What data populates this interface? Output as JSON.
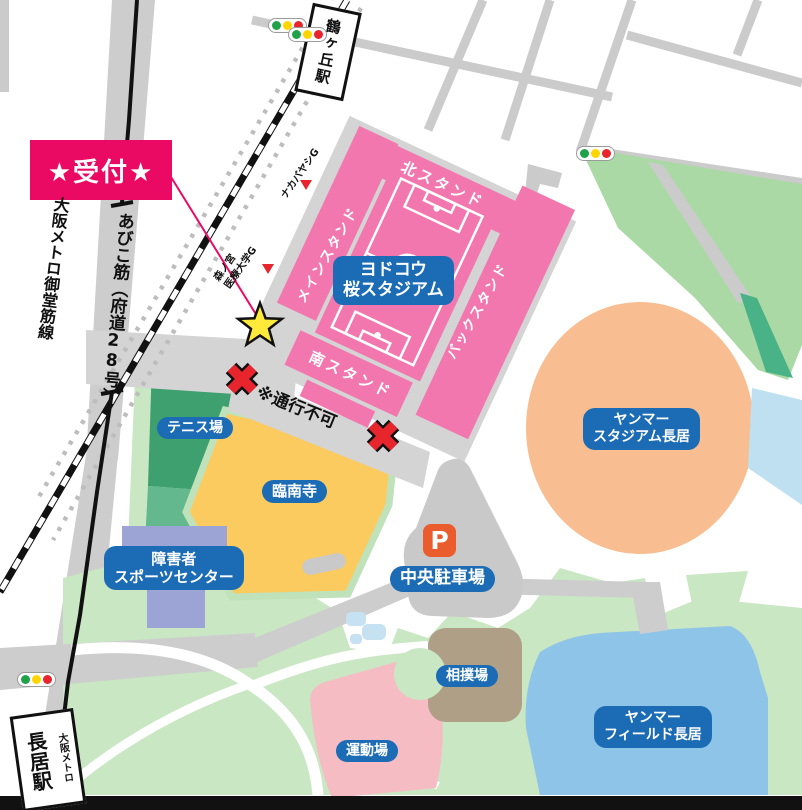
{
  "reception": {
    "label": "★受付★"
  },
  "stations": {
    "tsurugaoka": "鶴ヶ丘駅",
    "nagai": "長居駅",
    "nagai_operator": "大阪メトロ"
  },
  "roads": {
    "metro_line": "大阪メトロ御堂筋線",
    "abiko_prefix": "あびこ筋（府道",
    "abiko_number": "28",
    "abiko_suffix": "号）",
    "no_passage": "※通行不可"
  },
  "yodoko": {
    "name1": "ヨドコウ",
    "name2": "桜スタジアム",
    "north_stand": "北スタンド",
    "main_stand": "メインスタンド",
    "back_stand": "バックスタンド",
    "south_stand": "南スタンド"
  },
  "poi": {
    "tennis": "テニス場",
    "rinnanji": "臨南寺",
    "disabled1": "障害者",
    "disabled2": "スポーツセンター",
    "parking_symbol": "P",
    "central_parking": "中央駐車場",
    "yanmar_stadium1": "ヤンマー",
    "yanmar_stadium2": "スタジアム長居",
    "sumo": "相撲場",
    "sports_ground": "運動場",
    "yanmar_field1": "ヤンマー",
    "yanmar_field2": "フィールド長居"
  },
  "landmarks": {
    "nakabayashi": "ナカバヤシG",
    "morinomiya1": "森ノ宮",
    "morinomiya2": "医療大学G"
  },
  "colors": {
    "accent_magenta": "#EB0A63",
    "label_blue": "#1B6BB5",
    "stadium_pink": "#F277AE",
    "park_green": "#C9E7C3",
    "band_green": "#ABD9A5",
    "stadium_peach": "#F8BE92",
    "field_blue": "#8FC4E9",
    "temple_yellow": "#FBCB60",
    "parking_orange": "#EA5B2D",
    "star_yellow": "#FFE93B",
    "mark_red": "#E8242C",
    "signal_green": "#1FA24A",
    "signal_yellow": "#FFD500",
    "signal_red": "#E8242C"
  }
}
